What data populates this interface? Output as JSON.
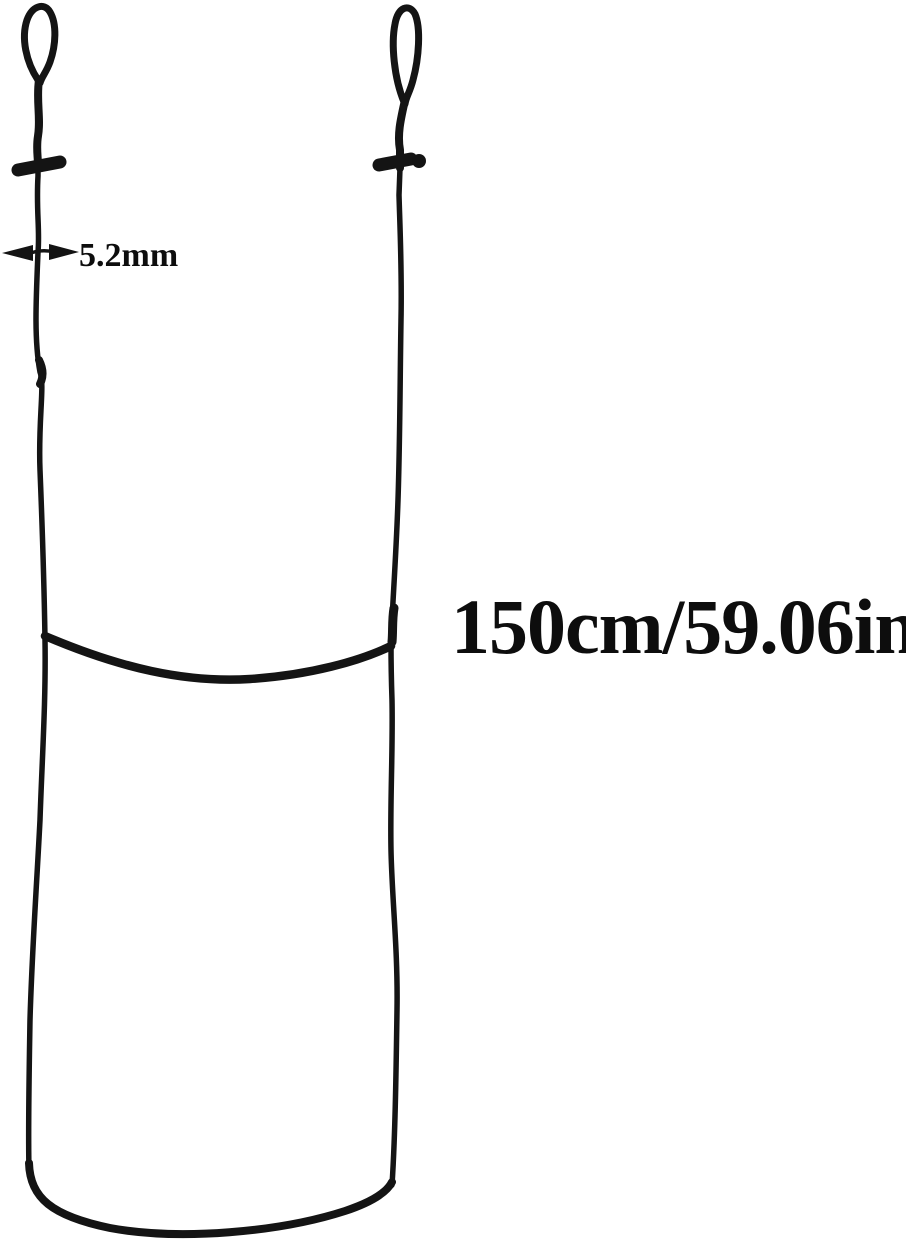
{
  "page": {
    "background_color": "#ffffff",
    "text_color": "#0d0d0d"
  },
  "illustration": {
    "cord_color": "#141414",
    "parts": {
      "left_loop": "cord-end-loop",
      "right_loop": "cord-end-loop",
      "left_toggle": "cord-toggle-bar",
      "right_toggle": "cord-toggle-bar",
      "middle_strand": "sagging-connector-strand",
      "bottom_fold": "bottom-fold-curve"
    }
  },
  "annotations": {
    "thickness": {
      "label": "5.2mm",
      "icon": "double-headed-horizontal-arrow-icon",
      "arrow_color": "#131313"
    },
    "length": {
      "label": "150cm/59.06in"
    }
  }
}
